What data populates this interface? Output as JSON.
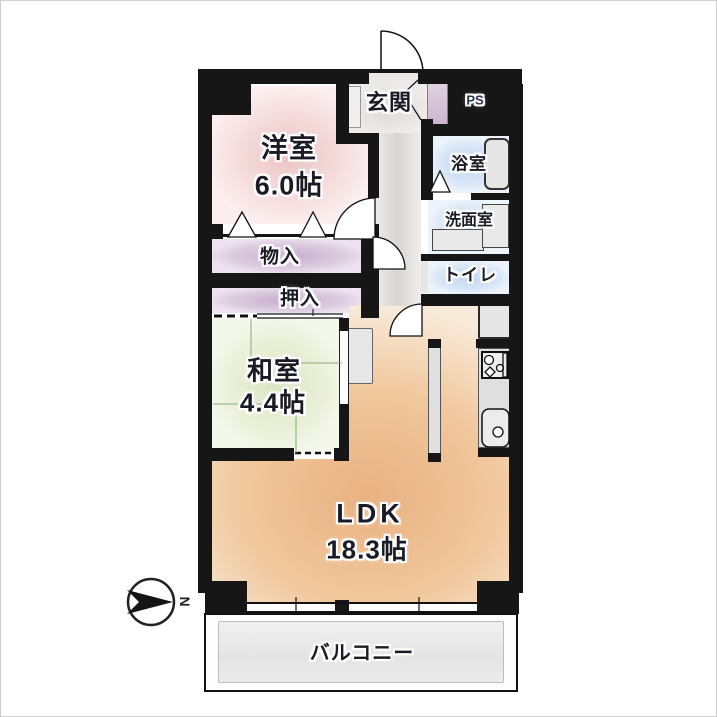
{
  "plan_title": "apartment-floor-plan",
  "compass": {
    "label": "N"
  },
  "rooms": {
    "genkan": {
      "label": "玄関"
    },
    "ps": {
      "label": "PS"
    },
    "yoshitsu": {
      "label": "洋室",
      "size": "6.0帖"
    },
    "bath": {
      "label": "浴室"
    },
    "washroom": {
      "label": "洗面室"
    },
    "toilet": {
      "label": "トイレ"
    },
    "monoire": {
      "label": "物入"
    },
    "oshiire": {
      "label": "押入"
    },
    "washitsu": {
      "label": "和室",
      "size": "4.4帖"
    },
    "ldk": {
      "label": "LDK",
      "size": "18.3帖"
    },
    "balcony": {
      "label": "バルコニー"
    }
  },
  "colors": {
    "wall": "#161616",
    "western_room_pink": "#ecc3c3",
    "closet_purple": "#c9abce",
    "japanese_room_green": "#dbe6c2",
    "ldk_orange": "#e9b181",
    "wet_area_blue": "#bed7f2",
    "hall_gray": "#d9d4d1",
    "balcony_gray": "#e4e4e4"
  }
}
